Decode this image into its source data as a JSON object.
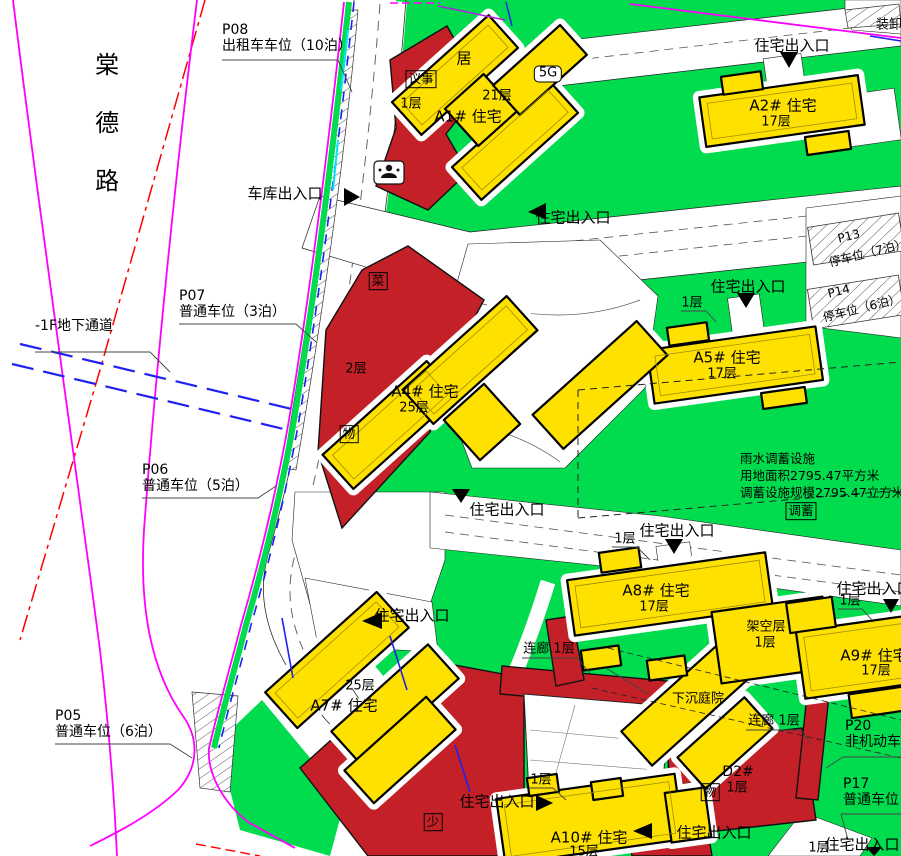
{
  "title": {
    "road_name": "棠德路"
  },
  "common": {
    "entrance": "住宅出入口",
    "garage_entrance": "车库出入口",
    "floor1": "1层",
    "floor2": "2层",
    "corridor": "连廊 1层",
    "stilt_floor": "架空层",
    "sunken_courtyard": "下沉庭院",
    "underground_passage": "-1F地下通道",
    "loading": "装卸"
  },
  "badges": {
    "council": "议事",
    "residence": "居",
    "g5": "5G",
    "vegetable": "菜",
    "property": "物",
    "youth": "少",
    "storage": "调蓄"
  },
  "buildings": {
    "a1": {
      "name": "A1# 住宅",
      "floors": "21层"
    },
    "a2": {
      "name": "A2# 住宅",
      "floors": "17层"
    },
    "a4": {
      "name": "A4# 住宅",
      "floors": "25层"
    },
    "a5": {
      "name": "A5# 住宅",
      "floors": "17层"
    },
    "a7": {
      "name": "A7# 住宅",
      "floors": "25层"
    },
    "a8": {
      "name": "A8# 住宅",
      "floors": "17层"
    },
    "a9": {
      "name": "A9# 住宅",
      "floors": "17层"
    },
    "a10": {
      "name": "A10# 住宅",
      "floors": "15层"
    },
    "d2": {
      "name": "D2#",
      "floors": "1层"
    }
  },
  "parking": {
    "p05": {
      "id": "P05",
      "desc": "普通车位（6泊）"
    },
    "p06": {
      "id": "P06",
      "desc": "普通车位（5泊）"
    },
    "p07": {
      "id": "P07",
      "desc": "普通车位（3泊）"
    },
    "p08": {
      "id": "P08",
      "desc": "出租车车位（10泊）"
    },
    "p13": {
      "id": "P13",
      "desc": "停车位（7泊）"
    },
    "p14": {
      "id": "P14",
      "desc": "停车位（6泊）"
    },
    "p17": {
      "id": "P17",
      "desc": "普通车位"
    },
    "p20": {
      "id": "P20",
      "desc": "非机动车位"
    }
  },
  "rainwater": {
    "line1": "雨水调蓄设施",
    "line2": "用地面积2795.47平方米",
    "line3": "调蓄设施规模2795.47立方米"
  },
  "colors": {
    "green": "#00dc4e",
    "yellow": "#ffe100",
    "red": "#c32127",
    "magenta": "#ff00ff",
    "blue": "#2020f0",
    "red_line": "#ff0000"
  }
}
